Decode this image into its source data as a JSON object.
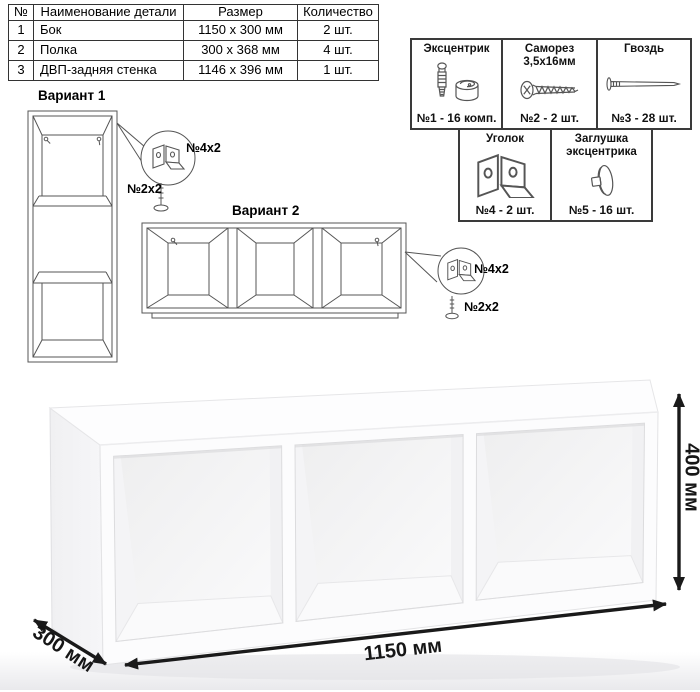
{
  "parts_table": {
    "headers": [
      "№",
      "Наименование детали",
      "Размер",
      "Количество"
    ],
    "rows": [
      {
        "num": "1",
        "name": "Бок",
        "size": "1150 x 300 мм",
        "qty": "2 шт."
      },
      {
        "num": "2",
        "name": "Полка",
        "size": "300 x 368 мм",
        "qty": "4 шт."
      },
      {
        "num": "3",
        "name": "ДВП-задняя стенка",
        "size": "1146 x 396 мм",
        "qty": "1 шт."
      }
    ]
  },
  "hardware_table": {
    "items": [
      {
        "title": "Эксцентрик",
        "subtitle": "",
        "count": "№1 - 16 комп.",
        "icon": "eccentric-cam-icon"
      },
      {
        "title": "Саморез",
        "subtitle": "3,5х16мм",
        "count": "№2 - 2 шт.",
        "icon": "screw-icon"
      },
      {
        "title": "Гвоздь",
        "subtitle": "",
        "count": "№3 - 28 шт.",
        "icon": "nail-icon"
      },
      {
        "title": "Уголок",
        "subtitle": "",
        "count": "№4 - 2 шт.",
        "icon": "corner-bracket-icon"
      },
      {
        "title": "Заглушка",
        "subtitle": "эксцентрика",
        "count": "№5 - 16 шт.",
        "icon": "eccentric-cap-icon"
      }
    ]
  },
  "variant1": {
    "title": "Вариант 1",
    "bracket_label": "№4x2",
    "screw_label": "№2x2"
  },
  "variant2": {
    "title": "Вариант 2",
    "bracket_label": "№4x2",
    "screw_label": "№2x2"
  },
  "dimensions": {
    "width": "1150 мм",
    "depth": "300 мм",
    "height": "400 мм"
  },
  "colors": {
    "line_art": "#555555",
    "table_border": "#333333",
    "text": "#111111",
    "dimension_arrow": "#1a1a1a",
    "photo_background": "#f2f2f3"
  }
}
